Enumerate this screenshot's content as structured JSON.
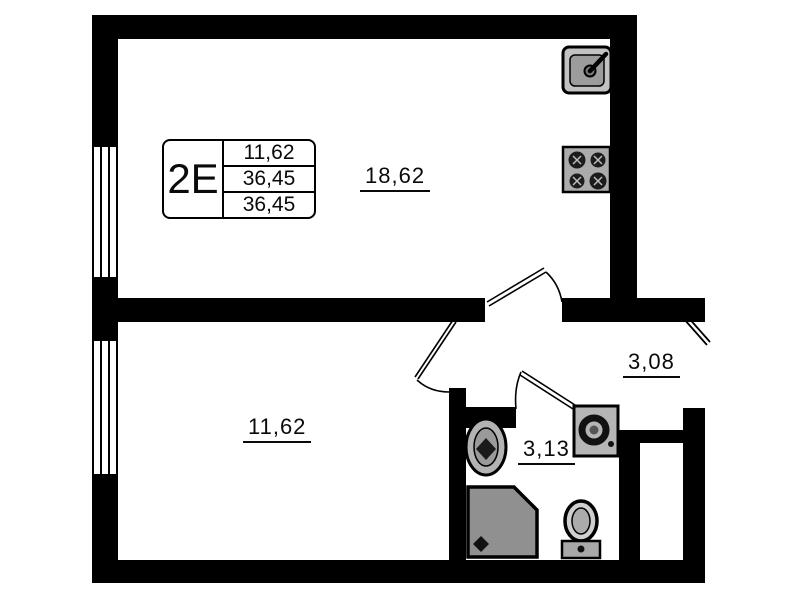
{
  "plan": {
    "background_color": "#ffffff",
    "wall_color": "#000000",
    "fixture_fill_color": "#a8a8a8"
  },
  "stamp": {
    "type_label": "2E",
    "rows": [
      "11,62",
      "36,45",
      "36,45"
    ]
  },
  "rooms": {
    "living": {
      "area": "18,62"
    },
    "bedroom": {
      "area": "11,62"
    },
    "hallway": {
      "area": "3,08"
    },
    "bathroom": {
      "area": "3,13"
    }
  },
  "fixtures": [
    "kitchen-sink",
    "stove",
    "washbasin",
    "shower",
    "toilet",
    "washing-machine"
  ]
}
